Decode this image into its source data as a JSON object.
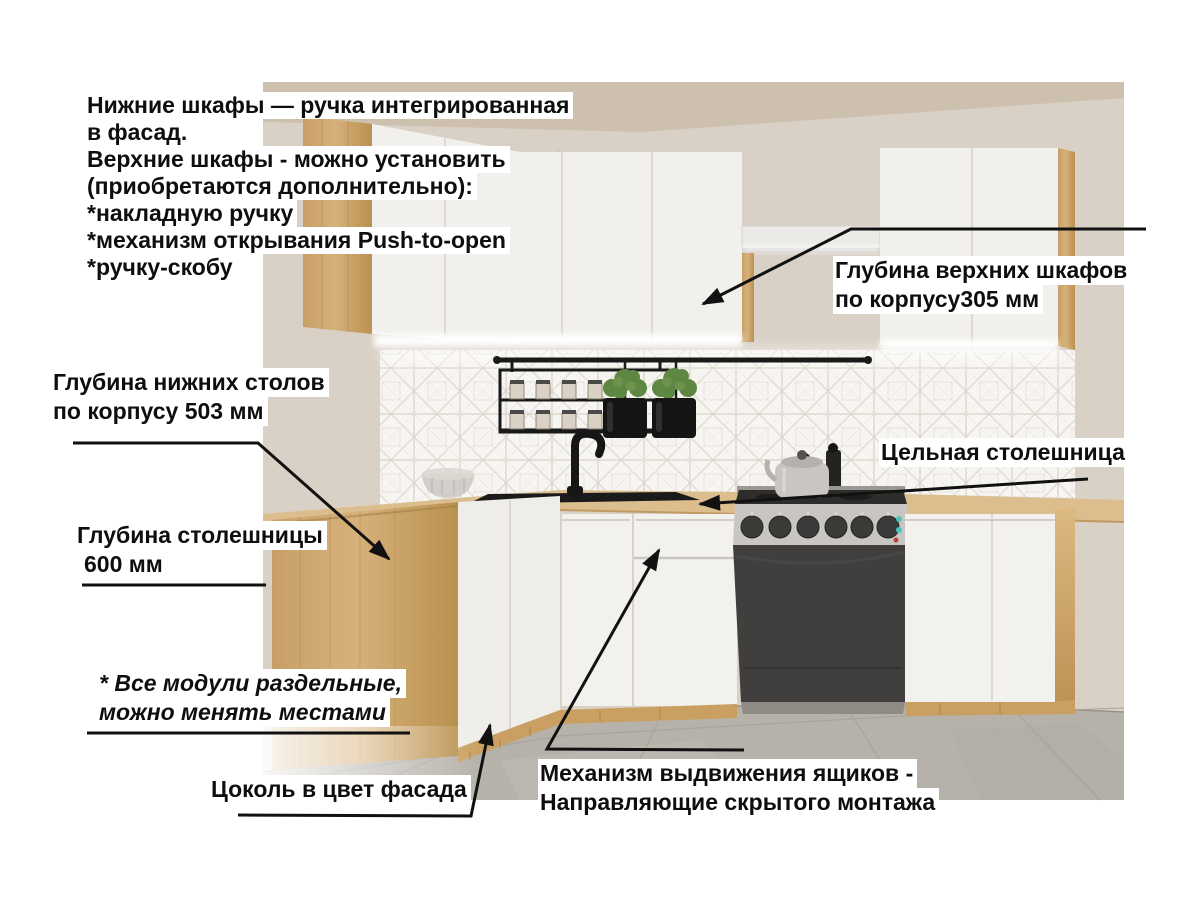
{
  "annotations": {
    "features_list": {
      "lines": [
        "Нижние шкафы — ручка интегрированная",
        "в фасад.",
        "Верхние шкафы - можно установить",
        "(приобретаются дополнительно):",
        "*накладную ручку",
        "*механизм открывания Push-to-open",
        "*ручку-скобу"
      ]
    },
    "upper_cabinet_depth": {
      "lines": [
        "Глубина верхних шкафов",
        "по корпусу305 мм"
      ]
    },
    "base_cabinet_depth": {
      "lines": [
        "Глубина нижних столов",
        "по корпусу 503 мм"
      ]
    },
    "countertop_depth": {
      "lines": [
        "Глубина столешницы",
        "600 мм"
      ]
    },
    "solid_countertop": {
      "text": "Цельная столешница"
    },
    "modules_note": {
      "lines": [
        "* Все модули раздельные,",
        "можно менять местами"
      ]
    },
    "plinth": {
      "text": "Цоколь в цвет фасада"
    },
    "drawer_mechanism": {
      "lines": [
        "Механизм выдвижения ящиков -",
        "Направляющие скрытого монтажа"
      ]
    }
  },
  "colors": {
    "text": "#0e0e0e",
    "label_bg": "#ffffff",
    "arrow": "#111111",
    "wall": "#d9d1c6",
    "ceiling": "#cdc0ae",
    "tile": "#f7f5f1",
    "tile_line": "#d8d2c9",
    "cabinet_white": "#f2f0ec",
    "seam": "#dcd9d3",
    "wood_light": "#d7b17b",
    "wood_dark": "#b9914f",
    "countertop": "#dcbd8d",
    "plinth_wood": "#c9a061",
    "floor": "#b6b2aa",
    "stove_front": "#403f3e",
    "steel": "#c9c6c1",
    "black_accent": "#1b1b1b",
    "plant_green": "#5d8742",
    "led_teal": "#49c7bd",
    "led_red": "#b8413a"
  }
}
